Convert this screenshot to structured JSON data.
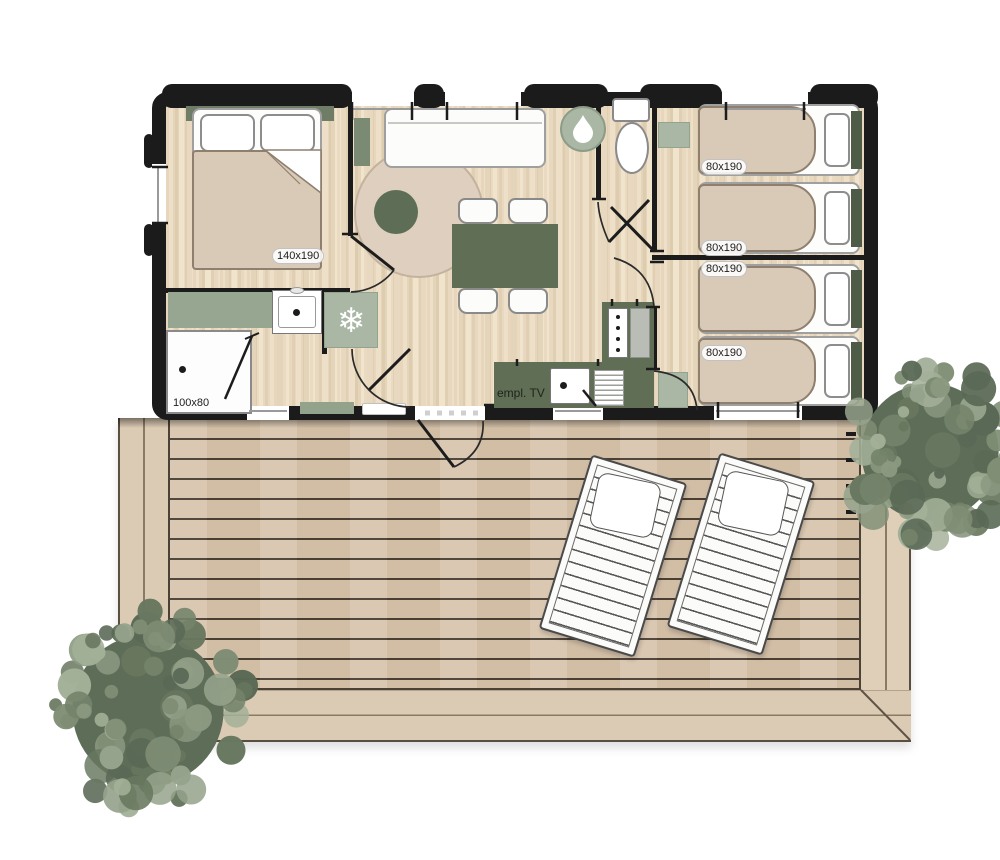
{
  "labels": {
    "master_bed": "140x190",
    "bed_1": "80x190",
    "bed_2": "80x190",
    "bed_3": "80x190",
    "bed_4": "80x190",
    "shower": "100x80",
    "tv_spot": "empl. TV"
  },
  "icons": {
    "fridge_glyph": "❄",
    "fridge": "snowflake-icon",
    "water_heater": "water-drop-icon"
  },
  "palette": {
    "wall": "#1b1b1b",
    "floor_wood": "#ecddc4",
    "sage_dark": "#5f6e55",
    "sage_mid": "#97a690",
    "sage_light": "#a9b7a4",
    "textile_beige": "#d9cab8",
    "deck_plank": "#d8c5ad",
    "deck_border": "#dbcbb4",
    "tree_green": "#6b7a68"
  }
}
